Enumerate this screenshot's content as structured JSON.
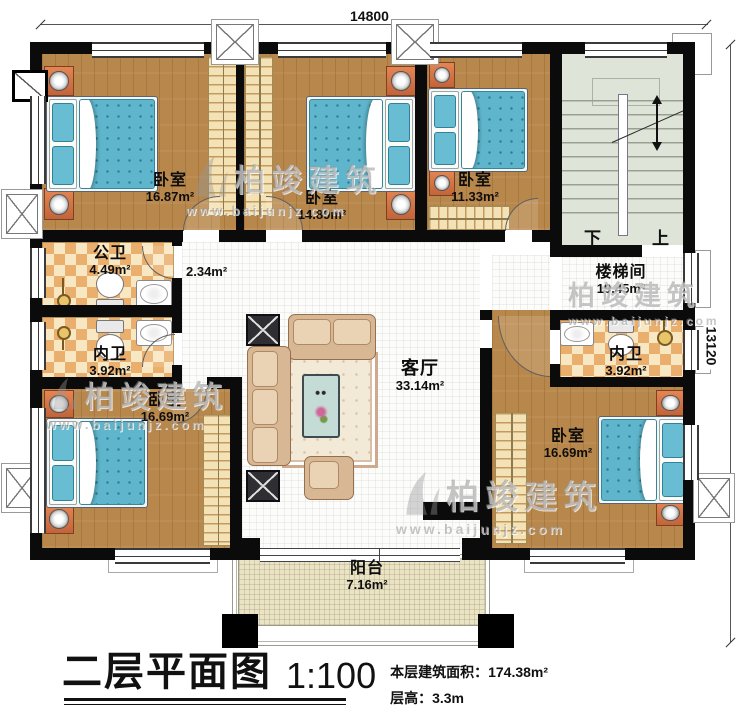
{
  "plan": {
    "title": "二层平面图",
    "scale": "1:100",
    "stats": {
      "area": "本层建筑面积：174.38m²",
      "floor_height": "层高：3.3m"
    },
    "dimensions": {
      "top": "14800",
      "right": "13120"
    },
    "watermark": {
      "brand": "柏竣建筑",
      "site": "www.baijunjz.com"
    },
    "stairs": {
      "down": "下",
      "up": "上"
    },
    "rooms": [
      {
        "id": "bedroom-top-left",
        "name": "卧室",
        "area": "16.87m²"
      },
      {
        "id": "bedroom-top-middle",
        "name": "卧室",
        "area": "14.89m²"
      },
      {
        "id": "bedroom-top-right",
        "name": "卧室",
        "area": "11.33m²"
      },
      {
        "id": "stairwell",
        "name": "楼梯间",
        "area": "19.45m²"
      },
      {
        "id": "public-bathroom",
        "name": "公卫",
        "area": "4.49m²"
      },
      {
        "id": "hallway",
        "name": "",
        "area": "2.34m²"
      },
      {
        "id": "bathroom-left",
        "name": "内卫",
        "area": "3.92m²"
      },
      {
        "id": "bedroom-bottom-left",
        "name": "卧室",
        "area": "16.69m²"
      },
      {
        "id": "living-room",
        "name": "客厅",
        "area": "33.14m²"
      },
      {
        "id": "bathroom-right",
        "name": "内卫",
        "area": "3.92m²"
      },
      {
        "id": "bedroom-bottom-right",
        "name": "卧室",
        "area": "16.69m²"
      },
      {
        "id": "balcony",
        "name": "阳台",
        "area": "7.16m²"
      }
    ]
  }
}
